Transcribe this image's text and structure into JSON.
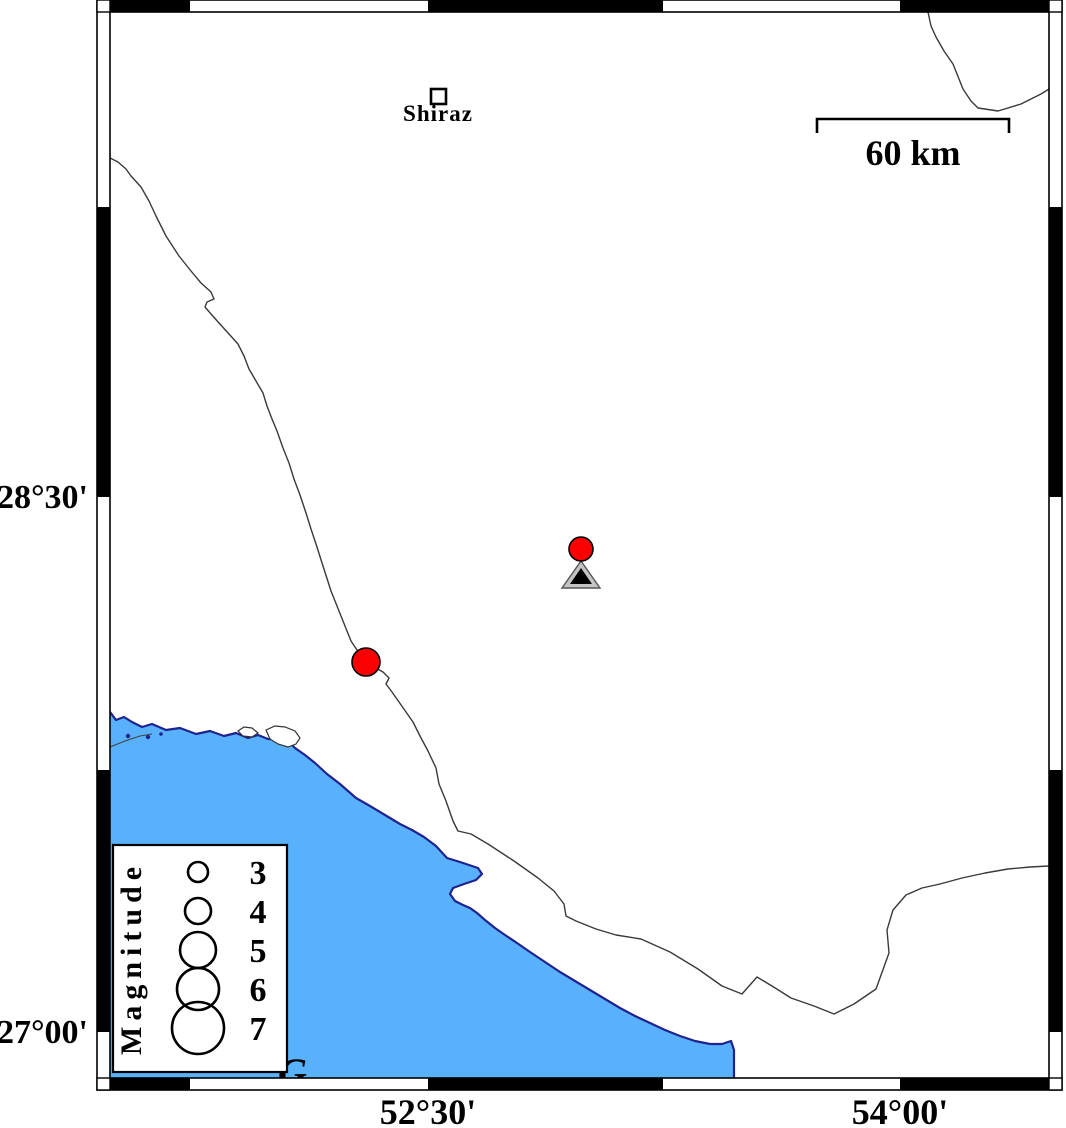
{
  "map": {
    "water_color": "#58b1fa",
    "coast_color": "#1e2390",
    "road_color": "#3a3a3a",
    "quake_color": "#fa0000",
    "station_fill": "#c4c4c4",
    "earthquakes": [
      {
        "x": 581,
        "y": 549,
        "r": 12
      },
      {
        "x": 366,
        "y": 662,
        "r": 14
      }
    ],
    "station": {
      "x": 581,
      "y": 588
    }
  },
  "places": {
    "shiraz": "Shiraz"
  },
  "labels": {
    "gulf_partial": "G"
  },
  "scalebar": {
    "label": "60 km"
  },
  "axes": {
    "left": [
      {
        "label": "28°30'",
        "y": 497
      },
      {
        "label": "27°00'",
        "y": 1032
      }
    ],
    "bottom": [
      {
        "label": "52°30'",
        "x": 428
      },
      {
        "label": "54°00'",
        "x": 900
      }
    ]
  },
  "legend": {
    "title": "Magnitude",
    "entries": [
      {
        "magnitude": "3",
        "r": 10
      },
      {
        "magnitude": "4",
        "r": 13
      },
      {
        "magnitude": "5",
        "r": 18
      },
      {
        "magnitude": "6",
        "r": 21
      },
      {
        "magnitude": "7",
        "r": 26
      }
    ]
  }
}
